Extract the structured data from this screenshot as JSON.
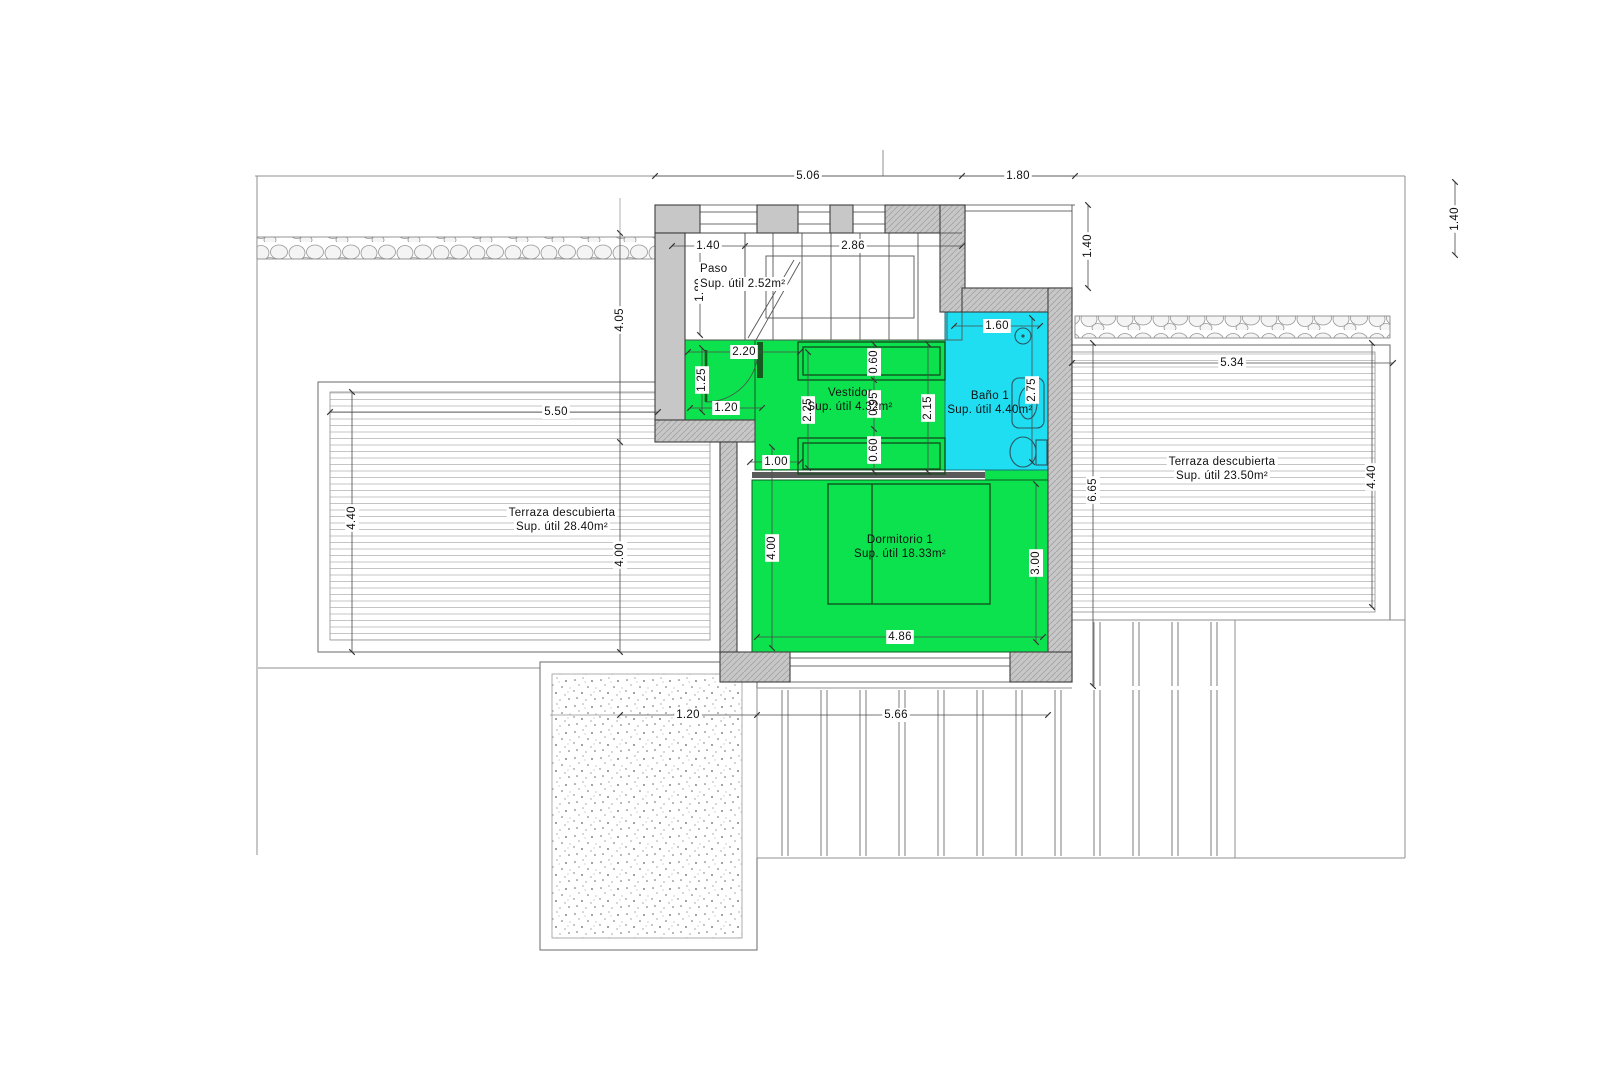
{
  "drawing": {
    "rooms": {
      "paso": {
        "name": "Paso",
        "area": "Sup. útil 2.52m²"
      },
      "vestidor": {
        "name": "Vestidor",
        "area": "Sup. útil 4.32m²"
      },
      "bano1": {
        "name": "Baño 1",
        "area": "Sup. útil 4.40m²"
      },
      "dormitorio1": {
        "name": "Dormitorio 1",
        "area": "Sup. útil 18.33m²"
      },
      "terraza_izquierda": {
        "name": "Terraza descubierta",
        "area": "Sup. útil 28.40m²"
      },
      "terraza_derecha": {
        "name": "Terraza descubierta",
        "area": "Sup. útil 23.50m²"
      }
    },
    "dims": {
      "top_main": "5.06",
      "top_right": "1.80",
      "right_setback": "1.40",
      "paso_w": "1.40",
      "stairs_w": "2.86",
      "paso_h": "1.80",
      "left_upper": "4.05",
      "left_lower": "4.00",
      "hall_w": "2.20",
      "hall_h": "1.25",
      "door_w": "1.20",
      "wall_gap": "1.00",
      "vest_left": "2.25",
      "closet_top": "0.60",
      "vest_mid": "0.95",
      "closet_bot": "0.60",
      "vest_right": "2.15",
      "bath_w": "1.60",
      "bath_h": "2.75",
      "niche_h": "1.40",
      "dorm_w": "4.86",
      "dorm_left": "4.00",
      "dorm_right": "3.00",
      "terr_izq_w": "5.50",
      "terr_izq_h": "4.40",
      "terr_der_w": "5.34",
      "terr_der_h": "4.40",
      "terr_der_left": "6.65",
      "gravel_w": "1.20",
      "pergola_w": "5.66"
    },
    "colors": {
      "green": "#0ce24e",
      "cyan": "#1fdef2",
      "wall": "#c7c7c7"
    }
  }
}
